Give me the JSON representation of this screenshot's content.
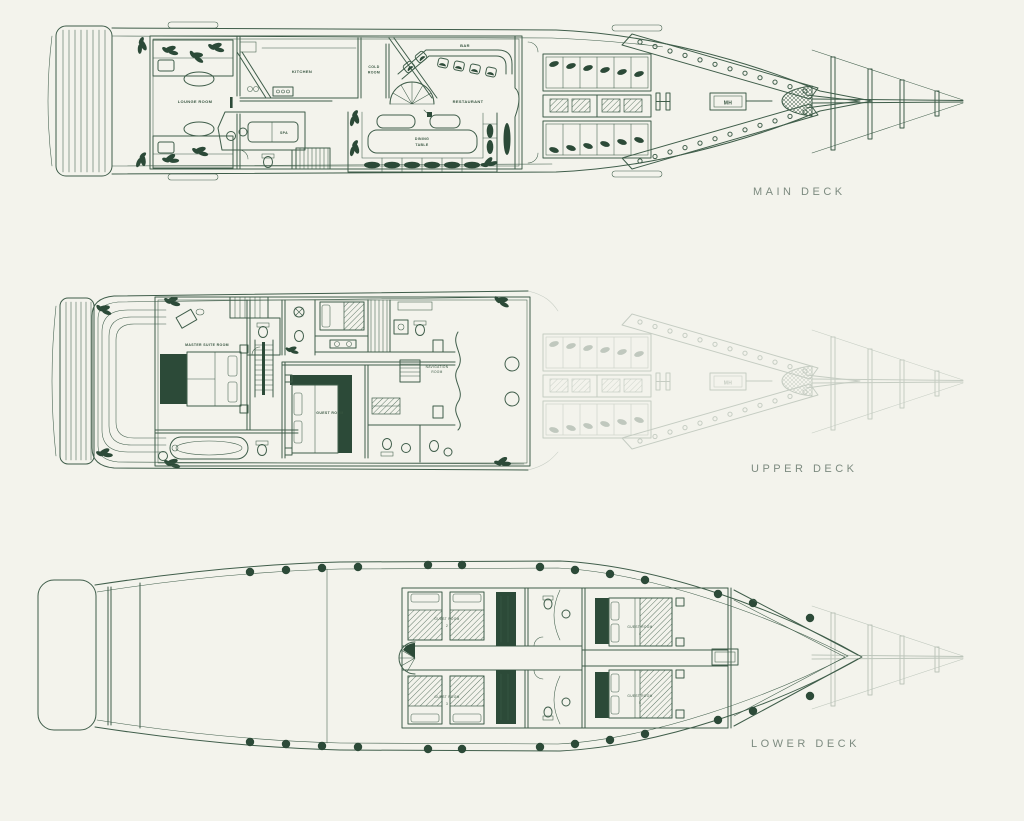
{
  "colors": {
    "background": "#f3f3ec",
    "line": "#3f5d4a",
    "dark_fill": "#2c4a38",
    "deck_title": "#7d8b80"
  },
  "decks": {
    "main": {
      "title": "MAIN DECK",
      "rooms": {
        "lounge": "LOUNGE ROOM",
        "kitchen": "KITCHEN",
        "cold_room": [
          "COLD",
          "ROOM"
        ],
        "bar": "BAR",
        "restaurant": "RESTAURANT",
        "spa": "SPA",
        "dining": [
          "DINING",
          "TABLE"
        ],
        "mh": "MH"
      }
    },
    "upper": {
      "title": "UPPER DECK",
      "rooms": {
        "master_suite": "MASTER SUITE ROOM",
        "guest": "GUEST ROOM",
        "navigation": [
          "NAVIGATION",
          "ROOM"
        ]
      }
    },
    "lower": {
      "title": "LOWER DECK",
      "rooms": [
        {
          "label": "GUEST ROOM",
          "number": "2"
        },
        {
          "label": "GUEST ROOM",
          "number": "3"
        },
        {
          "label": "GUEST ROOM",
          "number": "4"
        },
        {
          "label": "GUEST ROOM",
          "number": "5"
        }
      ]
    }
  }
}
